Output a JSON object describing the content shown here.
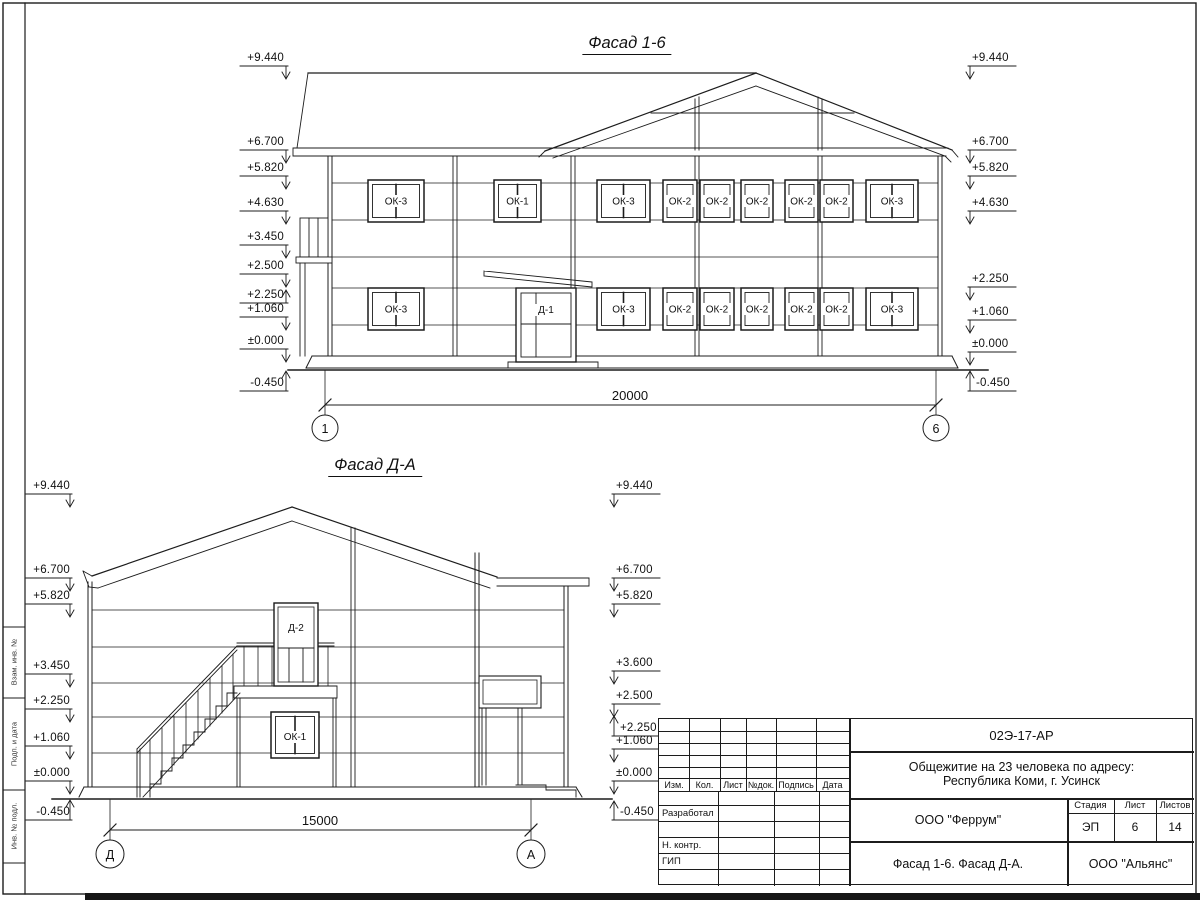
{
  "sheet": {
    "margin_labels": [
      "Взам. инв. №",
      "Подп. и дата",
      "Инв. № подл."
    ]
  },
  "facade_1_6": {
    "title": "Фасад 1-6",
    "left_marks": [
      "+9.440",
      "+6.700",
      "+5.820",
      "+4.630",
      "+3.450",
      "+2.500",
      "+2.250",
      "+1.060",
      "±0.000",
      "-0.450"
    ],
    "right_marks": [
      "+9.440",
      "+6.700",
      "+5.820",
      "+4.630",
      "+2.250",
      "+1.060",
      "±0.000",
      "-0.450"
    ],
    "upper_windows": [
      "ОК-3",
      "ОК-1",
      "ОК-3",
      "ОК-2",
      "ОК-2",
      "ОК-2",
      "ОК-2",
      "ОК-2",
      "ОК-3"
    ],
    "lower_windows": [
      "ОК-3",
      "Д-1",
      "ОК-3",
      "ОК-2",
      "ОК-2",
      "ОК-2",
      "ОК-2",
      "ОК-2",
      "ОК-3"
    ],
    "dimension": "20000",
    "axis_left": "1",
    "axis_right": "6"
  },
  "facade_d_a": {
    "title": "Фасад Д-А",
    "left_marks": [
      "+9.440",
      "+6.700",
      "+5.820",
      "+3.450",
      "+2.250",
      "+1.060",
      "±0.000",
      "-0.450"
    ],
    "right_marks": [
      "+9.440",
      "+6.700",
      "+5.820",
      "+3.600",
      "+2.500",
      "+2.250",
      "+1.060",
      "±0.000",
      "-0.450"
    ],
    "door_label": "Д-2",
    "window_label": "ОК-1",
    "dimension": "15000",
    "axis_left": "Д",
    "axis_right": "А"
  },
  "titleblock": {
    "doc_number": "02Э-17-АР",
    "project_name_line1": "Общежитие на 23 человека по адресу:",
    "project_name_line2": "Республика Коми, г. Усинск",
    "revision_headers": [
      "Изм.",
      "Кол.",
      "Лист",
      "№док.",
      "Подпись",
      "Дата"
    ],
    "role_labels": [
      "Разработал",
      "Н. контр.",
      "ГИП"
    ],
    "designer_org": "ООО \"Феррум\"",
    "stage_header": "Стадия",
    "sheet_header": "Лист",
    "sheets_header": "Листов",
    "stage_value": "ЭП",
    "sheet_value": "6",
    "sheets_value": "14",
    "drawing_title": "Фасад 1-6. Фасад Д-А.",
    "general_contractor": "ООО \"Альянс\""
  }
}
